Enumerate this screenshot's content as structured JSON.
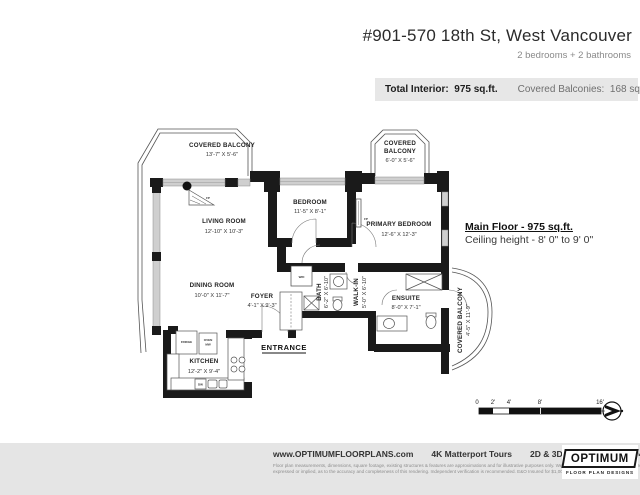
{
  "header": {
    "title": "#901-570 18th St, West Vancouver",
    "subtitle": "2 bedrooms + 2 bathrooms"
  },
  "info_bar": {
    "total_interior_label": "Total Interior:",
    "total_interior_value": "975 sq.ft.",
    "covered_balconies_label": "Covered Balconies:",
    "covered_balconies_value": "168 sq.ft."
  },
  "plan": {
    "rooms": {
      "covered_balcony_tl": {
        "name": "COVERED BALCONY",
        "dims": "13'-7\" X 5'-6\""
      },
      "living_room": {
        "name": "LIVING ROOM",
        "dims": "12'-10\" X 10'-3\""
      },
      "bedroom": {
        "name": "BEDROOM",
        "dims": "11'-5\" X 8'-1\""
      },
      "covered_balcony_top": {
        "name_line1": "COVERED",
        "name_line2": "BALCONY",
        "dims": "6'-0\" X 5'-6\""
      },
      "primary_bedroom": {
        "name": "PRIMARY BEDROOM",
        "dims": "12'-6\" X 12'-3\""
      },
      "dining_room": {
        "name": "DINING ROOM",
        "dims": "10'-0\" X 11'-7\""
      },
      "foyer": {
        "name": "FOYER",
        "dims": "4'-1\" X 9'-3\""
      },
      "bath": {
        "name": "BATH",
        "dims": "6'-2\" X 6'-10\""
      },
      "walk_in": {
        "name": "WALK-IN",
        "dims": "5'-0\" X 6'-10\""
      },
      "ensuite": {
        "name": "ENSUITE",
        "dims": "8'-0\" X 7'-1\""
      },
      "covered_balcony_right": {
        "name": "COVERED BALCONY",
        "dims": "4'-5\" X 11'-9\""
      },
      "kitchen": {
        "name": "KITCHEN",
        "dims": "12'-2\" X 9'-4\""
      }
    },
    "fixtures": {
      "fireplace": "FP",
      "washer_dryer": "W/D",
      "fridge": "FRIDGE",
      "oven": "OVEN",
      "microwave": "MW",
      "dishwasher": "DW"
    },
    "entrance_label": "ENTRANCE",
    "main_floor_title": "Main Floor - 975 sq.ft.",
    "ceiling_height": "Ceiling height - 8' 0\" to 9' 0\""
  },
  "scale_bar": {
    "ticks": [
      "0",
      "2'",
      "4'",
      "8'",
      "16'"
    ]
  },
  "footer": {
    "links": [
      "www.OPTIMUMFLOORPLANS.com",
      "4K Matterport Tours",
      "2D & 3D Floor Plans",
      "604-729-5033"
    ],
    "disclaimer_line1": "Floor plan measurements, dimensions, square footage, existing structures & features are approximations and for illustrative purposes only. We make no guarantee, warranty, or representation,",
    "disclaimer_line2": "expressed or implied, as to the accuracy and completeness of this rendering. Independent verification is recommended. E&O Insured for $1,000,000",
    "logo_name": "OPTIMUM",
    "logo_tagline": "FLOOR PLAN DESIGNS"
  },
  "colors": {
    "wall": "#1a1a1a",
    "window": "#cfcfcf",
    "band_bg": "#e7e7e7",
    "footer_bg": "#e5e5e5"
  }
}
